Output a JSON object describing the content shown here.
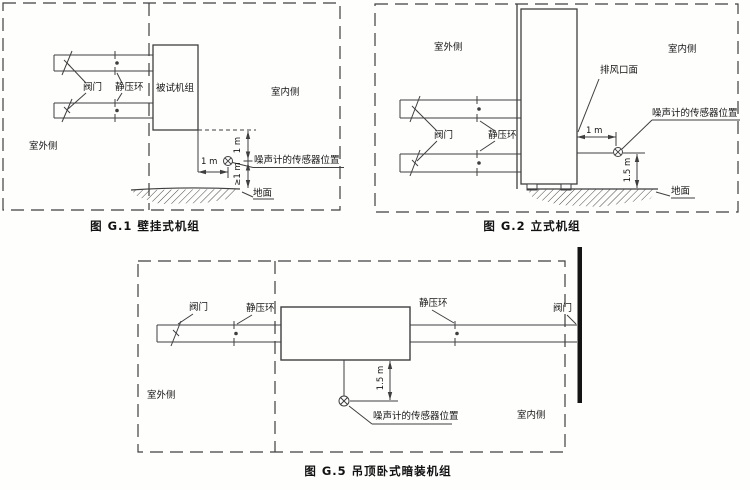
{
  "figure1": {
    "caption": "图 G.1  壁挂式机组",
    "labels": {
      "valve": "阀门",
      "static_ring": "静压环",
      "unit_under_test": "被试机组",
      "indoor_side": "室内侧",
      "outdoor_side": "室外侧",
      "dim_horizontal": "1 m",
      "dim_above_sensor": "1 m",
      "dim_below_sensor": "≥1 m",
      "sensor_position": "噪声计的传感器位置",
      "ground": "地面"
    }
  },
  "figure2": {
    "caption": "图 G.2  立式机组",
    "labels": {
      "outdoor_side": "室外侧",
      "indoor_side": "室内侧",
      "exhaust_outlet_face": "排风口面",
      "valve": "阀门",
      "static_ring": "静压环",
      "dim_horizontal": "1 m",
      "dim_vertical": "1.5 m",
      "sensor_position": "噪声计的传感器位置",
      "ground": "地面"
    }
  },
  "figure5": {
    "caption": "图 G.5  吊顶卧式暗装机组",
    "labels": {
      "valve_left": "阀门",
      "static_ring_left": "静压环",
      "static_ring_right": "静压环",
      "valve_right": "阀门",
      "outdoor_side": "室外侧",
      "indoor_side": "室内侧",
      "dim_vertical": "1.5 m",
      "sensor_position": "噪声计的传感器位置"
    }
  },
  "colors": {
    "line": "#3f3f3f",
    "text": "#151515",
    "background": "#fefefd",
    "wall_bar": "#141414"
  }
}
